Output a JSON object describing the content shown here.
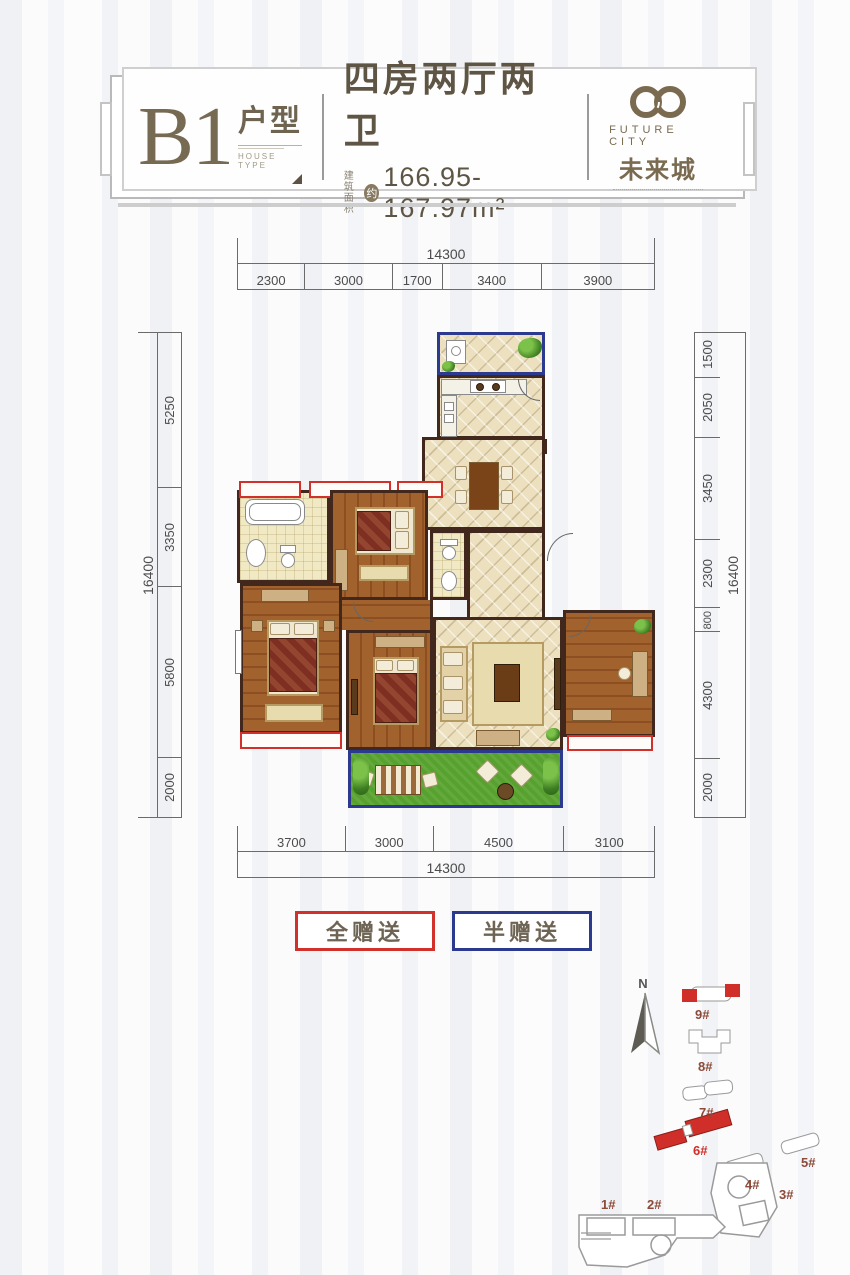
{
  "header": {
    "unit_code": "B1",
    "unit_type_cn": "户型",
    "unit_type_en": "HOUSE TYPE",
    "rooms_title": "四房两厅两卫",
    "area_label_1": "建筑",
    "area_label_2": "面积",
    "area_circle": "约",
    "area_value": "166.95-167.97m²",
    "brand_en": "FUTURE CITY",
    "brand_cn": "未来城"
  },
  "dimensions": {
    "top_total": "14300",
    "top_segments": [
      "2300",
      "3000",
      "1700",
      "3400",
      "3900"
    ],
    "bottom_segments": [
      "3700",
      "3000",
      "4500",
      "3100"
    ],
    "bottom_total": "14300",
    "left_total": "16400",
    "left_segments": [
      "5250",
      "3350",
      "5800",
      "2000"
    ],
    "right_segments": [
      "1500",
      "2050",
      "3450",
      "2300",
      "800",
      "4300",
      "2000"
    ],
    "right_total": "16400"
  },
  "legend": {
    "full_gift": "全赠送",
    "half_gift": "半赠送"
  },
  "compass": {
    "north": "N"
  },
  "site_plan": {
    "buildings": [
      {
        "label": "1#"
      },
      {
        "label": "2#"
      },
      {
        "label": "3#"
      },
      {
        "label": "4#"
      },
      {
        "label": "5#"
      },
      {
        "label": "6#"
      },
      {
        "label": "7#"
      },
      {
        "label": "8#"
      },
      {
        "label": "9#"
      }
    ]
  },
  "colors": {
    "accent_red": "#d2302a",
    "accent_blue": "#2b3a8f",
    "brand_brown": "#7a6b50",
    "wall_dark": "#42281c",
    "grass_green": "#57a22e"
  }
}
